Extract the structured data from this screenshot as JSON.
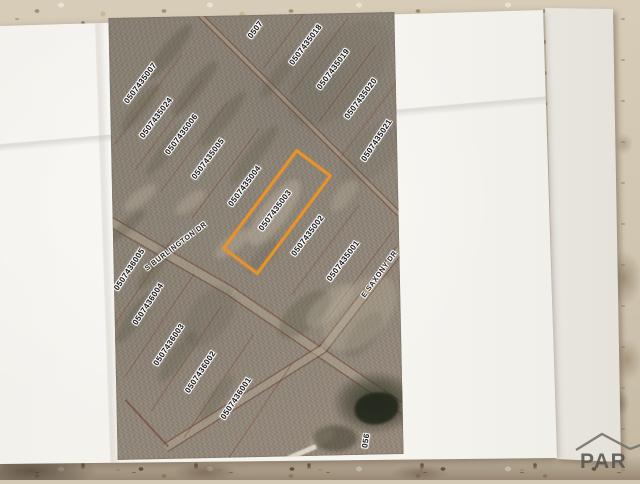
{
  "photo": {
    "subject": "printed aerial parcel map on paper sheets",
    "watermark": {
      "text": "PAR",
      "icon": "house-roof-icon"
    }
  },
  "map": {
    "highlighted_parcel": "0507435003",
    "highlight_color": "#e8942e",
    "parcel_labels": [
      {
        "text": "0507",
        "x": 147,
        "y": 15,
        "rot": -52
      },
      {
        "text": "0507435018",
        "x": 197,
        "y": 31,
        "rot": -52
      },
      {
        "text": "0507435019",
        "x": 224,
        "y": 56,
        "rot": -52
      },
      {
        "text": "0507435020",
        "x": 251,
        "y": 86,
        "rot": -52
      },
      {
        "text": "0507435021",
        "x": 266,
        "y": 128,
        "rot": -55
      },
      {
        "text": "0507435007",
        "x": 31,
        "y": 66,
        "rot": -52
      },
      {
        "text": "0507435024",
        "x": 46,
        "y": 101,
        "rot": -52
      },
      {
        "text": "0507435006",
        "x": 71,
        "y": 118,
        "rot": -52
      },
      {
        "text": "0507435005",
        "x": 97,
        "y": 143,
        "rot": -52
      },
      {
        "text": "0507435004",
        "x": 133,
        "y": 171,
        "rot": -52
      },
      {
        "text": "0507435003",
        "x": 163,
        "y": 196,
        "rot": -52
      },
      {
        "text": "0507435002",
        "x": 195,
        "y": 222,
        "rot": -52
      },
      {
        "text": "0507435001",
        "x": 230,
        "y": 248,
        "rot": -52
      },
      {
        "text": "0507436005",
        "x": 16,
        "y": 252,
        "rot": -55
      },
      {
        "text": "0507436004",
        "x": 34,
        "y": 287,
        "rot": -55
      },
      {
        "text": "0507436003",
        "x": 54,
        "y": 328,
        "rot": -55
      },
      {
        "text": "0507436002",
        "x": 85,
        "y": 356,
        "rot": -55
      },
      {
        "text": "0507436001",
        "x": 120,
        "y": 383,
        "rot": -55
      },
      {
        "text": "056",
        "x": 249,
        "y": 428,
        "rot": -80
      }
    ],
    "street_labels": [
      {
        "text": "S BURLINGTON DR",
        "x": 63,
        "y": 230,
        "rot": -36
      },
      {
        "text": "E SAXONY DR",
        "x": 266,
        "y": 262,
        "rot": -53
      }
    ]
  }
}
